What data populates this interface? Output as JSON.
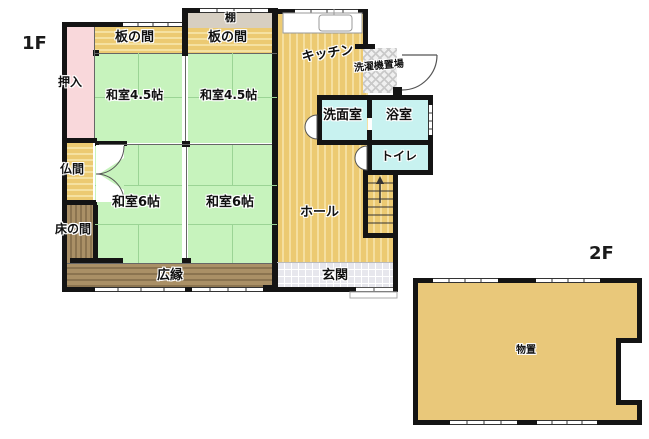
{
  "floor_labels": {
    "f1": "1F",
    "f2": "2F"
  },
  "rooms": {
    "oshiire": "押入",
    "itanoma_left": "板の間",
    "itanoma_right": "板の間",
    "tana": "棚",
    "kitchen": "キッチン",
    "laundry": "洗濯機置場",
    "washitsu45_left": "和室4.5帖",
    "washitsu45_right": "和室4.5帖",
    "senmenshitsu": "洗面室",
    "yokushitsu": "浴室",
    "toilet": "トイレ",
    "butsuma": "仏間",
    "washitsu6_left": "和室6帖",
    "washitsu6_right": "和室6帖",
    "hall": "ホール",
    "tokonoma": "床の間",
    "hiroen": "広縁",
    "genkan": "玄関",
    "monooki": "物置"
  },
  "colors": {
    "tatami_green": "#c7f3bd",
    "wood_gold": "#ecca72",
    "veranda_brown": "#aa9066",
    "closet_pink": "#f9d8db",
    "wet_area_cyan": "#c8f2f0",
    "entry_gray": "#e7e7ed",
    "shelf_gray": "#d7cfc2",
    "storage_gold": "#e9c87a",
    "wall_black": "#141414"
  }
}
